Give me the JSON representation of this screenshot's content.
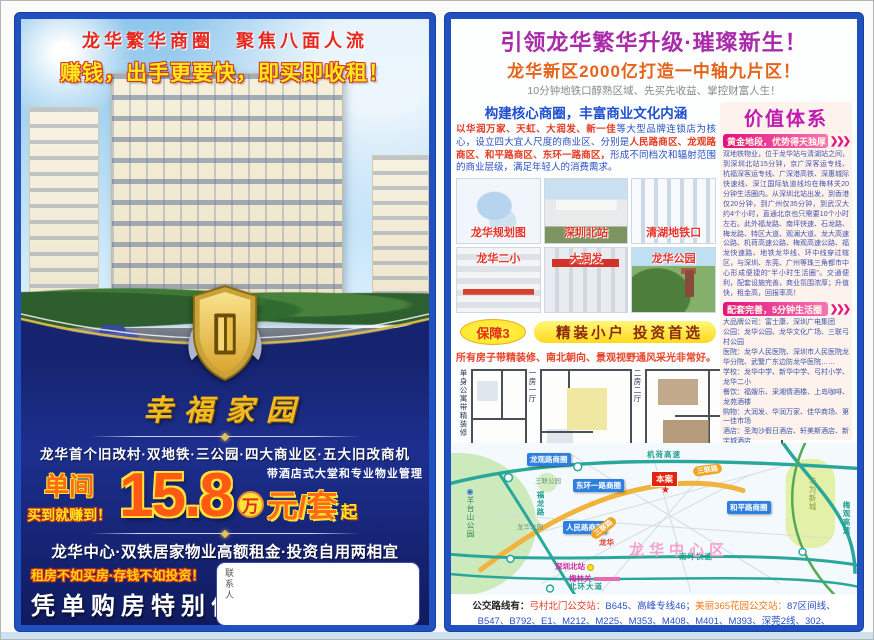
{
  "left_page": {
    "brand_line": "龙华繁华商圈　聚焦八面人流",
    "hook_line": "赚钱，出手更要快，即买即收租！",
    "estate_name": "幸福家园",
    "features": "龙华首个旧改村·双地铁·三公园·四大商业区·五大旧改商机",
    "price": {
      "unit_label": "单间",
      "buy_note": "买到就赚到！",
      "amount": "15.8",
      "wan": "万",
      "per": "元/套",
      "qi": "起",
      "mgmt": "带酒店式大堂和专业物业管理"
    },
    "slogan_main": "龙华中心·双铁居家物业高额租金·投资自用两相宜",
    "slogan_sub": "租房不如买房·存钱不如投资！",
    "promo": "凭单购房特别优惠",
    "address": "地址：龙华新区清湖美丽365花园附近(清湖地铁口旁)",
    "contact_label": "联系人"
  },
  "right_page": {
    "headline": "引领龙华繁华升级·璀璨新生！",
    "subhead": "龙华新区2000亿打造一中轴九片区！",
    "tagline": "10分钟地铁口醇熟区域、先买先收益、掌控财富人生！",
    "commerce": {
      "header": "构建核心商圈，丰富商业文化内涵",
      "seg1": "以华润万家、天虹、大润发、新一佳",
      "seg2": "等大型品牌连锁店为核心，设立四大宜人尺度的商业区、分别是",
      "seg3": "人民路商区、龙观路商区、和平路商区、东环一路商区，",
      "seg4": "形成不同档次和辐射范围的商业层级，满足年轻人的消费需求。",
      "photos": [
        "龙华规划图",
        "深圳北站",
        "清湖地铁口",
        "龙华二小",
        "大润发",
        "龙华公园"
      ]
    },
    "guarantee": {
      "badge": "保障3",
      "title": "精装小户  投资首选",
      "note": "所有房子带精装修、南北朝向、景观视野通风采光非常好。",
      "plans": [
        "单身公寓带精装修",
        "一房一厅",
        "二房二厅"
      ]
    },
    "value": {
      "title": "价值体系",
      "s1_header": "黄金地段，优势得天独厚",
      "s1_body": "双地铁物业，位于龙华站与清湖站之间，到深圳北站15分钟，京广深客运专线、杭福深客运专线、广深港高铁、深惠城际快速线、深江国际轨道线均在梅林关20分钟生活圈内。从深圳北站出发，到香港仅20分钟，到广州仅35分钟，到武汉大约4个小时，直通北京也只需要10个小时左右。此外福龙路、南坪快速、石龙路、梅龙路、特区大道、观澜大道、龙大高速公路、机荷高速公路、梅观高速公路、福龙快速路、地铁龙华线、环中线穿过辖区，与深圳、东莞、广州等珠三角都市中心形成便捷的“半小时生活圈”。交通便利，配套设施完善，商业氛围浓厚；升值快，租金高，回报率高！",
      "s2_header": "配套完善，5分钟生活圈",
      "s2_body": "大品牌公司：富士康、深圳广电集团\n公园：龙华公园、龙华文化广场、三联弓村公园\n医院：龙华人民医院、深圳市人民医院龙华分院、武警广东边防龙华医院……\n学校：龙华中学、新华中学、弓村小学、龙华二小\n餐饮：福嫂乐、采湘情酒楼、上岛咖啡、龙苑酒楼\n购物：大润发、华润万家、佳华商场、第一佳市场\n酒店：圣淘沙假日酒店、轩美斯酒店、新宇城酒店\n银行：四大银行、平安银行、中信银行、东亚银行",
      "s3_header": "靠山天然氧吧·风水宝地",
      "s3_body": "项目四面地处龙华新区旧改第一村(弓村)，青山环绕，紧邻占地4万平方米的原生态弓山公园，在风水学上形成“明堂之地”，有着百年历史的弓山，孕育了多种珍贵树种以及白鹭、猫头鹰等生物，绿色生态，是天然的氧吧。"
    },
    "map": {
      "highways": {
        "jihe": "机荷高速",
        "meiguan": "梅观高速",
        "nanping": "南坪快速",
        "beihuan": "北环大道",
        "fulong": "福龙路"
      },
      "areas": {
        "yangtaishan": "羊台山公园",
        "huawei": "华为新城",
        "center": "龙华中心区",
        "sanlian_park": "三联公园",
        "longhua_park": "龙华公园"
      },
      "biz": {
        "longguan": "龙观路商圈",
        "donghuan": "东环一路商圈",
        "heping": "和平路商圈",
        "renmin": "人民路商圈"
      },
      "site": "本案",
      "roads": {
        "sanlian1": "三联路",
        "sanlian2": "三联路"
      },
      "stations": {
        "north": "深圳北站",
        "meilin": "梅林关",
        "longhua": "龙华"
      }
    },
    "bus": {
      "label": "公交路线有：",
      "stop1": "弓村北门公交站：",
      "routes1": "B645、高峰专线46；",
      "stop2": "美丽365花园公交站：",
      "routes2": "87区间线、B547、B792、E1、M212、M225、M353、M408、M401、M393、深莞2线、302、M242。"
    }
  },
  "icons": {
    "chevrons": "❯❯❯",
    "star": "★",
    "park": "◉"
  }
}
